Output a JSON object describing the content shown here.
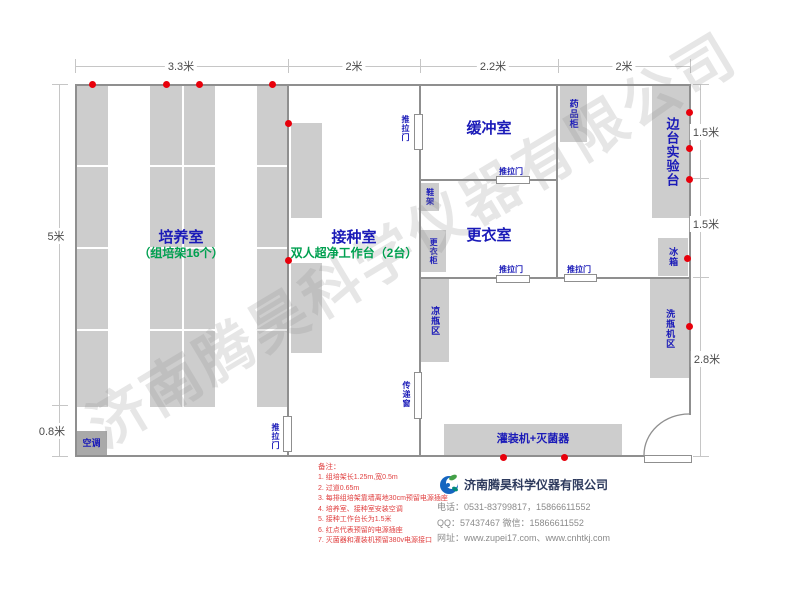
{
  "watermark": "济南腾昊科学仪器有限公司",
  "dims": {
    "top": [
      "3.3米",
      "2米",
      "2.2米",
      "2米"
    ],
    "left": [
      "5米",
      "0.8米"
    ],
    "right": [
      "1.5米",
      "1.5米",
      "2.8米"
    ]
  },
  "rooms": {
    "cultivation": {
      "title": "培养室",
      "subtitle": "（组培架16个）"
    },
    "inoculation": {
      "title": "接种室",
      "subtitle": "双人超净工作台（2台）"
    },
    "buffer": {
      "title": "缓冲室"
    },
    "changing": {
      "title": "更衣室"
    }
  },
  "fixtures": {
    "side_bench": "边台实验台",
    "medicine_cabinet": "药品柜",
    "fridge": "冰箱",
    "washer_area": "洗瓶机区",
    "cooling_area": "凉瓶区",
    "wardrobe": "更衣柜",
    "shoe_rack": "鞋架",
    "transfer_window": "传递窗",
    "sliding_door": "推拉门",
    "filler": "灌装机+灭菌器",
    "air_conditioner": "空调"
  },
  "notes": {
    "title": "备注：",
    "items": [
      "1. 组培架长1.25m,宽0.5m",
      "2. 过道0.65m",
      "3. 每排组培架靠墙离地30cm预留电源插座",
      "4. 培养室、接种室安装空调",
      "5. 接种工作台长为1.5米",
      "6. 红点代表预留的电源插座",
      "7. 灭菌器和灌装机预留380v电源接口"
    ]
  },
  "company": {
    "name": "济南腾昊科学仪器有限公司",
    "phone": "电话：0531-83799817，15866611552",
    "qq": "QQ：57437467    微信：15866611552",
    "web": "网址：www.zupei17.com、www.cnhtkj.com"
  },
  "colors": {
    "label_blue": "#1a1ab8",
    "label_green": "#00a050",
    "outlet_red": "#e8000b",
    "note_red": "#e04040",
    "block_gray": "#cdcdcd",
    "wall_gray": "#8f8f8f"
  }
}
